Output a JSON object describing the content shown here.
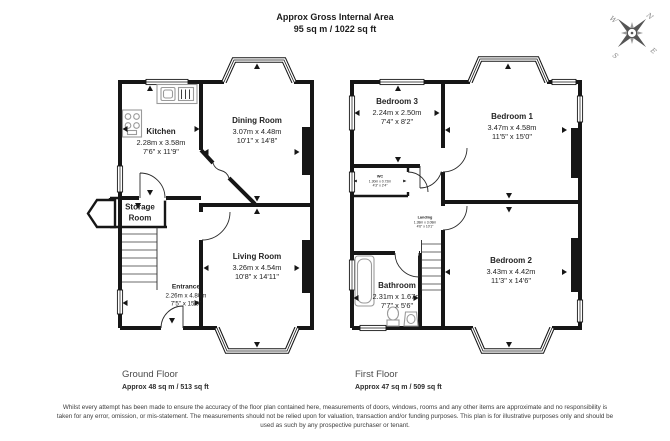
{
  "header": {
    "title": "Approx Gross Internal Area",
    "subtitle": "95 sq m / 1022 sq ft"
  },
  "compass": {
    "n": "N",
    "e": "E",
    "s": "S",
    "w": "W"
  },
  "ground_floor": {
    "label": "Ground Floor",
    "area": "Approx 48 sq m / 513 sq ft",
    "rooms": {
      "kitchen": {
        "name": "Kitchen",
        "metric": "2.28m x 3.58m",
        "imperial": "7'6\" x 11'9\""
      },
      "dining": {
        "name": "Dining Room",
        "metric": "3.07m x 4.48m",
        "imperial": "10'1\" x 14'8\""
      },
      "storage": {
        "name": "Storage Room"
      },
      "entrance": {
        "name": "Entrance",
        "metric": "2.26m x 4.80m",
        "imperial": "7'5\" x 15'9\""
      },
      "living": {
        "name": "Living Room",
        "metric": "3.26m x 4.54m",
        "imperial": "10'8\" x 14'11\""
      }
    }
  },
  "first_floor": {
    "label": "First Floor",
    "area": "Approx 47 sq m / 509 sq ft",
    "rooms": {
      "bedroom3": {
        "name": "Bedroom 3",
        "metric": "2.24m x 2.50m",
        "imperial": "7'4\" x 8'2\""
      },
      "bedroom1": {
        "name": "Bedroom 1",
        "metric": "3.47m x 4.58m",
        "imperial": "11'5\" x 15'0\""
      },
      "wc": {
        "name": "WC",
        "metric": "1.30m x 0.72m",
        "imperial": "4'3\" x 2'4\""
      },
      "landing": {
        "name": "Landing",
        "metric": "1.38m x 3.08m",
        "imperial": "4'6\" x 10'1\""
      },
      "bathroom": {
        "name": "Bathroom",
        "metric": "2.31m x 1.67m",
        "imperial": "7'7\" x 5'6\""
      },
      "bedroom2": {
        "name": "Bedroom 2",
        "metric": "3.43m x 4.42m",
        "imperial": "11'3\" x 14'6\""
      }
    }
  },
  "footer": {
    "disclaimer": "Whilst every attempt has been made to ensure the accuracy of the floor plan contained here, measurements of doors, windows, rooms and any other items are approximate and no responsibility is taken for any error, omission, or mis-statement. The measurements should not be relied upon for valuation, transaction and/or funding purposes. This plan is for illustrative purposes only and should be used as such by any prospective purchaser or tenant."
  }
}
